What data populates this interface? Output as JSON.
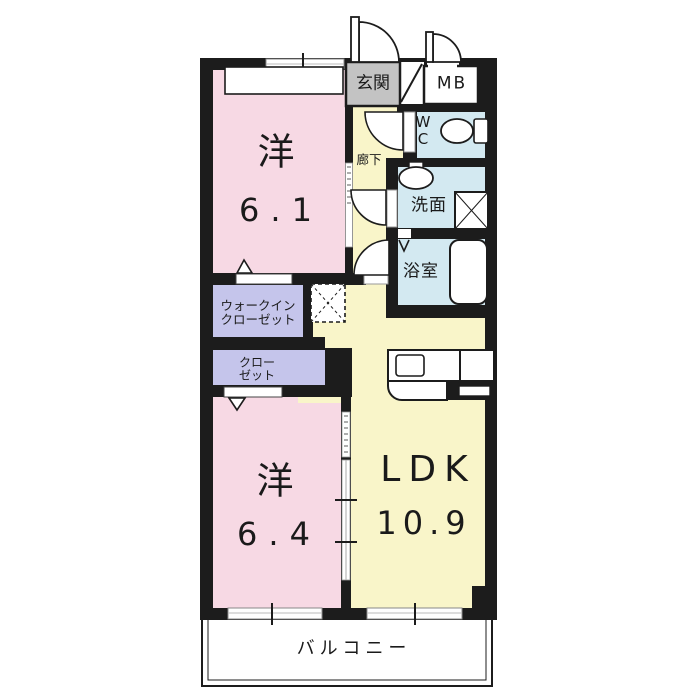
{
  "floorplan": {
    "colors": {
      "wall": "#1c1c1c",
      "bedroom_pink": "#f7d9e4",
      "living_yellow": "#f9f5c9",
      "closet_lavender": "#c5c5eb",
      "wet_area_blue": "#d3e9f1",
      "entrance_gray": "#c3c3c3",
      "background": "#ffffff"
    },
    "rooms": {
      "entrance": {
        "label": "玄関"
      },
      "meter_box": {
        "label": "MB"
      },
      "toilet": {
        "label_line1": "W",
        "label_line2": "C"
      },
      "hallway": {
        "label": "廊下"
      },
      "washroom": {
        "label": "洗面"
      },
      "bathroom": {
        "label": "浴室"
      },
      "bedroom1": {
        "type": "洋",
        "size": "6.1"
      },
      "walkin_closet": {
        "label_line1": "ウォークイン",
        "label_line2": "クローゼット"
      },
      "closet": {
        "label_line1": "クロー",
        "label_line2": "ゼット"
      },
      "bedroom2": {
        "type": "洋",
        "size": "6.4"
      },
      "ldk": {
        "label": "LDK",
        "size": "10.9"
      },
      "balcony": {
        "label": "バルコニー"
      }
    }
  }
}
